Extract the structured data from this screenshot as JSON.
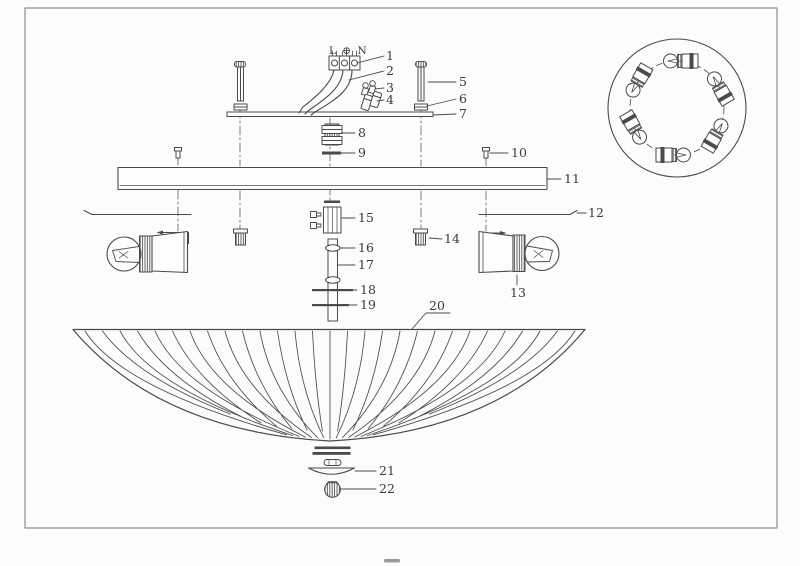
{
  "palette": {
    "background": "#fcfcfb",
    "ink": "#4a4a4a",
    "border": "#8f8f8f",
    "label_ink": "#3b3b3b"
  },
  "terminal": {
    "marking": "L ⊕ N"
  },
  "parts": {
    "p1": "1",
    "p2": "2",
    "p3": "3",
    "p4": "4",
    "p5": "5",
    "p6": "6",
    "p7": "7",
    "p8": "8",
    "p9": "9",
    "p10": "10",
    "p11": "11",
    "p12": "12",
    "p13": "13",
    "p14": "14",
    "p15": "15",
    "p16": "16",
    "p17": "17",
    "p18": "18",
    "p19": "19",
    "p20": "20",
    "p21": "21",
    "p22": "22"
  }
}
